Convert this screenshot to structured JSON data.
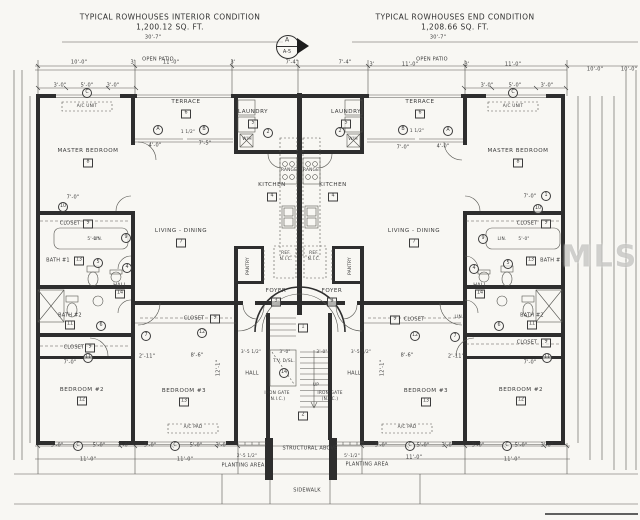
{
  "titles": {
    "left_line1": "TYPICAL ROWHOUSES INTERIOR CONDITION",
    "left_line2": "1,200.12 SQ. FT.",
    "right_line1": "TYPICAL ROWHOUSES END CONDITION",
    "right_line2": "1,208.66 SQ. FT."
  },
  "detail_marker": {
    "letter": "A",
    "sheet": "A-5"
  },
  "watermark": "MLS",
  "plan": {
    "labels": [
      {
        "t": "30'-7\"",
        "x": 153,
        "y": 38
      },
      {
        "t": "30'-7\"",
        "x": 438,
        "y": 38
      },
      {
        "t": "OPEN PATIO",
        "x": 158,
        "y": 60
      },
      {
        "t": "OPEN PATIO",
        "x": 432,
        "y": 60
      },
      {
        "t": "10'-0\"",
        "x": 79,
        "y": 63
      },
      {
        "t": "3'",
        "x": 133,
        "y": 63
      },
      {
        "t": "11'-0\"",
        "x": 171,
        "y": 63
      },
      {
        "t": "3'",
        "x": 233,
        "y": 63
      },
      {
        "t": "7'-4\"",
        "x": 292,
        "y": 63
      },
      {
        "t": "7'-4\"",
        "x": 345,
        "y": 63
      },
      {
        "t": "3'",
        "x": 372,
        "y": 65
      },
      {
        "t": "11'-0\"",
        "x": 410,
        "y": 65
      },
      {
        "t": "3'",
        "x": 467,
        "y": 65
      },
      {
        "t": "11'-0\"",
        "x": 513,
        "y": 65
      },
      {
        "t": "10'-0\"",
        "x": 595,
        "y": 70
      },
      {
        "t": "10'-0\"",
        "x": 629,
        "y": 70
      },
      {
        "t": "3'-0\"",
        "x": 60,
        "y": 86
      },
      {
        "t": "5'-0\"",
        "x": 87,
        "y": 86
      },
      {
        "t": "3'-0\"",
        "x": 113,
        "y": 86
      },
      {
        "t": "3'-0\"",
        "x": 487,
        "y": 86
      },
      {
        "t": "5'-0\"",
        "x": 515,
        "y": 86
      },
      {
        "t": "3'-0\"",
        "x": 547,
        "y": 86
      },
      {
        "t": "A/C UNIT",
        "x": 87,
        "y": 107,
        "s": "tiny"
      },
      {
        "t": "A/C UNIT",
        "x": 513,
        "y": 107,
        "s": "tiny"
      },
      {
        "t": "MASTER BEDROOM",
        "x": 88,
        "y": 152,
        "s": "room"
      },
      {
        "t": "TERRACE",
        "x": 186,
        "y": 103,
        "s": "room"
      },
      {
        "t": "LAUNDRY",
        "x": 253,
        "y": 113,
        "s": "room"
      },
      {
        "t": "KITCHEN",
        "x": 272,
        "y": 186,
        "s": "room"
      },
      {
        "t": "LIVING - DINING",
        "x": 181,
        "y": 232,
        "s": "room"
      },
      {
        "t": "PANTRY",
        "x": 249,
        "y": 266,
        "r": 1,
        "s": "tiny"
      },
      {
        "t": "FOYER",
        "x": 276,
        "y": 292,
        "s": "room"
      },
      {
        "t": "HALL",
        "x": 120,
        "y": 286
      },
      {
        "t": "CLOSET",
        "x": 70,
        "y": 224
      },
      {
        "t": "BATH #1",
        "x": 58,
        "y": 261
      },
      {
        "t": "LIN.",
        "x": 98,
        "y": 240,
        "s": "tiny"
      },
      {
        "t": "BATH #2",
        "x": 70,
        "y": 316
      },
      {
        "t": "CLOSET",
        "x": 74,
        "y": 348
      },
      {
        "t": "BEDROOM #2",
        "x": 82,
        "y": 391,
        "s": "room"
      },
      {
        "t": "CLOSET",
        "x": 194,
        "y": 319
      },
      {
        "t": "BEDROOM #3",
        "x": 184,
        "y": 392,
        "s": "room"
      },
      {
        "t": "HALL",
        "x": 252,
        "y": 374
      },
      {
        "t": "T.V. D/SL.",
        "x": 284,
        "y": 362,
        "s": "tiny"
      },
      {
        "t": "IRON GATE",
        "x": 277,
        "y": 394,
        "s": "tiny"
      },
      {
        "t": "(N.I.C.)",
        "x": 277,
        "y": 400,
        "s": "tiny"
      },
      {
        "t": "UP",
        "x": 316,
        "y": 386,
        "s": "tiny"
      },
      {
        "t": "MASTER BEDROOM",
        "x": 518,
        "y": 152,
        "s": "room"
      },
      {
        "t": "TERRACE",
        "x": 420,
        "y": 103,
        "s": "room"
      },
      {
        "t": "LAUNDRY",
        "x": 346,
        "y": 113,
        "s": "room"
      },
      {
        "t": "KITCHEN",
        "x": 333,
        "y": 186,
        "s": "room"
      },
      {
        "t": "LIVING - DINING",
        "x": 414,
        "y": 232,
        "s": "room"
      },
      {
        "t": "PANTRY",
        "x": 351,
        "y": 266,
        "r": 1,
        "s": "tiny"
      },
      {
        "t": "FOYER",
        "x": 332,
        "y": 292,
        "s": "room"
      },
      {
        "t": "HALL",
        "x": 480,
        "y": 286
      },
      {
        "t": "CLOSET",
        "x": 527,
        "y": 224
      },
      {
        "t": "BATH #1",
        "x": 552,
        "y": 261
      },
      {
        "t": "LIN.",
        "x": 502,
        "y": 240,
        "s": "tiny"
      },
      {
        "t": "BATH #2",
        "x": 532,
        "y": 316
      },
      {
        "t": "CLOSET",
        "x": 527,
        "y": 343
      },
      {
        "t": "BEDROOM #2",
        "x": 521,
        "y": 391,
        "s": "room"
      },
      {
        "t": "CLOSET",
        "x": 414,
        "y": 320
      },
      {
        "t": "LIN.",
        "x": 459,
        "y": 318,
        "s": "tiny"
      },
      {
        "t": "BEDROOM #3",
        "x": 426,
        "y": 392,
        "s": "room"
      },
      {
        "t": "HALL",
        "x": 354,
        "y": 374
      },
      {
        "t": "IRON GATE",
        "x": 330,
        "y": 394,
        "s": "tiny"
      },
      {
        "t": "(N.I.C.)",
        "x": 330,
        "y": 400,
        "s": "tiny"
      },
      {
        "t": "W/H",
        "x": 247,
        "y": 140,
        "s": "tiny"
      },
      {
        "t": "W/H",
        "x": 353,
        "y": 140,
        "s": "tiny"
      },
      {
        "t": "RANGE",
        "x": 289,
        "y": 171,
        "s": "tiny"
      },
      {
        "t": "RANGE",
        "x": 311,
        "y": 171,
        "s": "tiny"
      },
      {
        "t": "REF.",
        "x": 286,
        "y": 254,
        "s": "tiny"
      },
      {
        "t": "N.I.C.",
        "x": 286,
        "y": 260,
        "s": "tiny"
      },
      {
        "t": "REF.",
        "x": 314,
        "y": 254,
        "s": "tiny"
      },
      {
        "t": "N.I.C.",
        "x": 314,
        "y": 260,
        "s": "tiny"
      },
      {
        "t": "A/C PAD",
        "x": 193,
        "y": 428,
        "s": "tiny"
      },
      {
        "t": "A/C PAD",
        "x": 407,
        "y": 428,
        "s": "tiny"
      },
      {
        "t": "4'-0\"",
        "x": 155,
        "y": 146
      },
      {
        "t": "7'-5\"",
        "x": 205,
        "y": 144
      },
      {
        "t": "1 1/2\"",
        "x": 188,
        "y": 133,
        "s": "tiny"
      },
      {
        "t": "7'-0\"",
        "x": 403,
        "y": 148
      },
      {
        "t": "4'-0\"",
        "x": 443,
        "y": 147
      },
      {
        "t": "1 1/2\"",
        "x": 417,
        "y": 132,
        "s": "tiny"
      },
      {
        "t": "7'-0\"",
        "x": 73,
        "y": 198
      },
      {
        "t": "7'-0\"",
        "x": 530,
        "y": 197
      },
      {
        "t": "5'-0\"",
        "x": 93,
        "y": 240,
        "s": "tiny"
      },
      {
        "t": "5'-0\"",
        "x": 524,
        "y": 240,
        "s": "tiny"
      },
      {
        "t": "3'-5 1/2\"",
        "x": 251,
        "y": 353,
        "s": "tiny"
      },
      {
        "t": "3'-0\"",
        "x": 285,
        "y": 353,
        "s": "tiny"
      },
      {
        "t": "3'-0\"",
        "x": 322,
        "y": 353,
        "s": "tiny"
      },
      {
        "t": "3'-5 1/2\"",
        "x": 361,
        "y": 353,
        "s": "tiny"
      },
      {
        "t": "7'-0\"",
        "x": 70,
        "y": 363
      },
      {
        "t": "2'-11\"",
        "x": 147,
        "y": 357
      },
      {
        "t": "8'-6\"",
        "x": 197,
        "y": 356
      },
      {
        "t": "8'-6\"",
        "x": 407,
        "y": 356
      },
      {
        "t": "2'-11\"",
        "x": 456,
        "y": 357
      },
      {
        "t": "7'-0\"",
        "x": 530,
        "y": 363
      },
      {
        "t": "12'-1\"",
        "x": 219,
        "y": 368,
        "r": 1
      },
      {
        "t": "12'-1\"",
        "x": 383,
        "y": 368,
        "r": 1
      },
      {
        "t": "3'-0\"",
        "x": 57,
        "y": 446
      },
      {
        "t": "5'-0\"",
        "x": 99,
        "y": 446
      },
      {
        "t": "3'-0\"",
        "x": 124,
        "y": 446
      },
      {
        "t": "11'-0\"",
        "x": 88,
        "y": 460
      },
      {
        "t": "3'-0\"",
        "x": 150,
        "y": 446
      },
      {
        "t": "5'-0\"",
        "x": 196,
        "y": 446
      },
      {
        "t": "3'-0\"",
        "x": 222,
        "y": 446
      },
      {
        "t": "11'-0\"",
        "x": 185,
        "y": 460
      },
      {
        "t": "3'-0\"",
        "x": 381,
        "y": 446
      },
      {
        "t": "5'-0\"",
        "x": 423,
        "y": 446
      },
      {
        "t": "3'-0\"",
        "x": 448,
        "y": 446
      },
      {
        "t": "11'-0\"",
        "x": 414,
        "y": 458
      },
      {
        "t": "3'-0\"",
        "x": 478,
        "y": 446
      },
      {
        "t": "5'-0\"",
        "x": 521,
        "y": 446
      },
      {
        "t": "3'-0\"",
        "x": 547,
        "y": 446
      },
      {
        "t": "11'-0\"",
        "x": 512,
        "y": 460
      },
      {
        "t": "2'-5 1/2\"",
        "x": 247,
        "y": 457,
        "s": "tiny"
      },
      {
        "t": "5'-1/2\"",
        "x": 352,
        "y": 457,
        "s": "tiny"
      },
      {
        "t": "PLANTING AREA",
        "x": 243,
        "y": 466
      },
      {
        "t": "PLANTING AREA",
        "x": 367,
        "y": 465
      },
      {
        "t": "STRUCTURAL ABOVE",
        "x": 310,
        "y": 449
      },
      {
        "t": "SIDEWALK",
        "x": 307,
        "y": 491
      }
    ],
    "square_tags": [
      {
        "t": "8",
        "x": 88,
        "y": 163
      },
      {
        "t": "8",
        "x": 518,
        "y": 163
      },
      {
        "t": "6",
        "x": 186,
        "y": 114
      },
      {
        "t": "6",
        "x": 420,
        "y": 114
      },
      {
        "t": "5",
        "x": 253,
        "y": 124
      },
      {
        "t": "5",
        "x": 346,
        "y": 124
      },
      {
        "t": "4",
        "x": 272,
        "y": 197
      },
      {
        "t": "4",
        "x": 333,
        "y": 197
      },
      {
        "t": "7",
        "x": 181,
        "y": 243
      },
      {
        "t": "7",
        "x": 414,
        "y": 243
      },
      {
        "t": "3",
        "x": 276,
        "y": 302
      },
      {
        "t": "3",
        "x": 332,
        "y": 302
      },
      {
        "t": "13",
        "x": 79,
        "y": 261
      },
      {
        "t": "13",
        "x": 531,
        "y": 261
      },
      {
        "t": "11",
        "x": 70,
        "y": 325
      },
      {
        "t": "11",
        "x": 532,
        "y": 325
      },
      {
        "t": "14",
        "x": 120,
        "y": 294
      },
      {
        "t": "14",
        "x": 480,
        "y": 294
      },
      {
        "t": "9",
        "x": 88,
        "y": 224
      },
      {
        "t": "9",
        "x": 546,
        "y": 224
      },
      {
        "t": "9",
        "x": 215,
        "y": 319
      },
      {
        "t": "9",
        "x": 395,
        "y": 320
      },
      {
        "t": "9",
        "x": 90,
        "y": 348
      },
      {
        "t": "9",
        "x": 546,
        "y": 343
      },
      {
        "t": "12",
        "x": 82,
        "y": 401
      },
      {
        "t": "12",
        "x": 521,
        "y": 401
      },
      {
        "t": "13",
        "x": 184,
        "y": 402
      },
      {
        "t": "13",
        "x": 426,
        "y": 402
      },
      {
        "t": "1",
        "x": 303,
        "y": 328
      },
      {
        "t": "2",
        "x": 303,
        "y": 416
      }
    ],
    "circle_tags": [
      {
        "t": "C",
        "x": 87,
        "y": 93
      },
      {
        "t": "C",
        "x": 513,
        "y": 93
      },
      {
        "t": "A",
        "x": 158,
        "y": 130
      },
      {
        "t": "B",
        "x": 204,
        "y": 130
      },
      {
        "t": "B",
        "x": 403,
        "y": 130
      },
      {
        "t": "A",
        "x": 448,
        "y": 131
      },
      {
        "t": "2",
        "x": 268,
        "y": 133
      },
      {
        "t": "2",
        "x": 340,
        "y": 132
      },
      {
        "t": "10",
        "x": 63,
        "y": 207
      },
      {
        "t": "10",
        "x": 538,
        "y": 209
      },
      {
        "t": "9",
        "x": 126,
        "y": 238
      },
      {
        "t": "9",
        "x": 483,
        "y": 239
      },
      {
        "t": "5",
        "x": 98,
        "y": 263
      },
      {
        "t": "5",
        "x": 508,
        "y": 264
      },
      {
        "t": "4",
        "x": 127,
        "y": 268
      },
      {
        "t": "4",
        "x": 474,
        "y": 269
      },
      {
        "t": "6",
        "x": 101,
        "y": 326
      },
      {
        "t": "6",
        "x": 499,
        "y": 326
      },
      {
        "t": "7",
        "x": 146,
        "y": 336
      },
      {
        "t": "7",
        "x": 455,
        "y": 337
      },
      {
        "t": "12",
        "x": 202,
        "y": 333
      },
      {
        "t": "12",
        "x": 415,
        "y": 336
      },
      {
        "t": "11",
        "x": 88,
        "y": 358
      },
      {
        "t": "11",
        "x": 547,
        "y": 358
      },
      {
        "t": "14",
        "x": 284,
        "y": 373
      },
      {
        "t": "1",
        "x": 546,
        "y": 196
      },
      {
        "t": "C",
        "x": 78,
        "y": 446
      },
      {
        "t": "C",
        "x": 175,
        "y": 446
      },
      {
        "t": "C",
        "x": 410,
        "y": 446
      },
      {
        "t": "C",
        "x": 507,
        "y": 446
      }
    ]
  }
}
